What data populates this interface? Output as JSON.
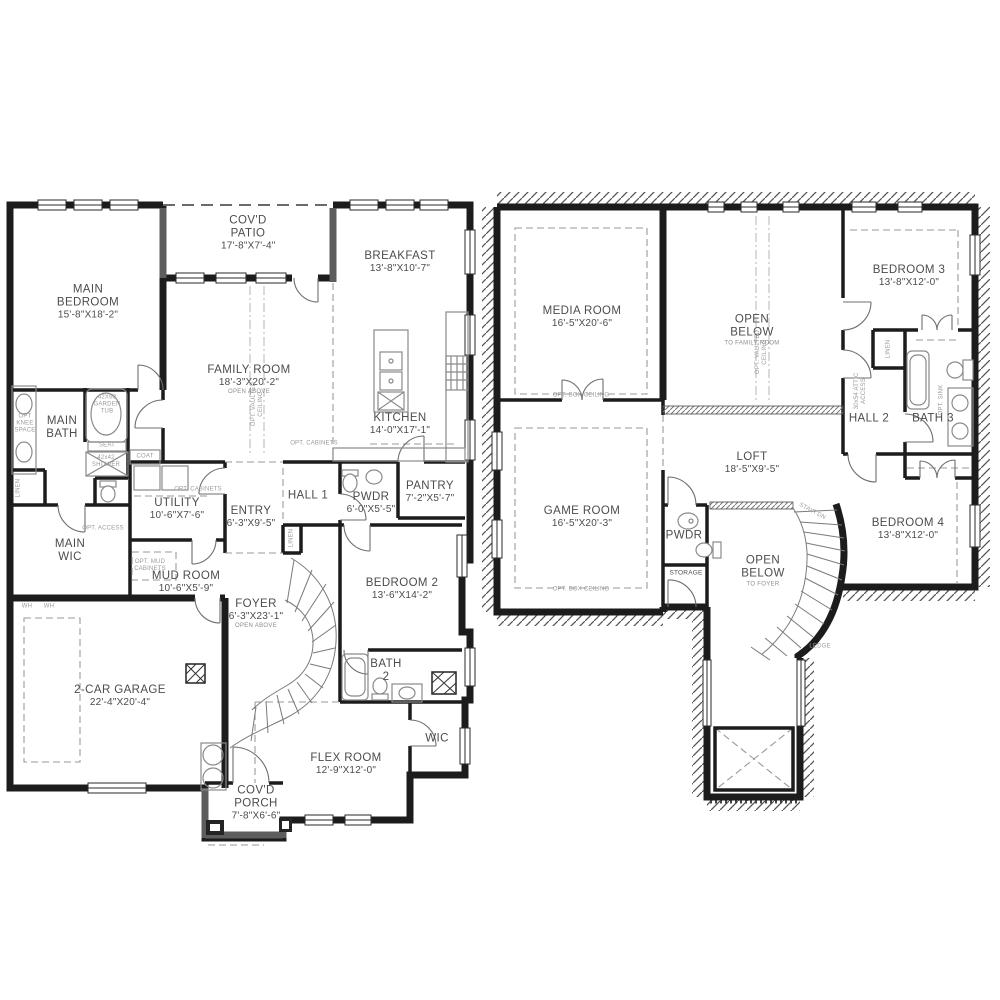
{
  "colors": {
    "bg": "#ffffff",
    "wall": "#1c1c1c",
    "wall_light": "#5d5d5d",
    "label": "#4c4c4c",
    "annot": "#9b9b9b",
    "fixture": "#8a8a8a",
    "dash": "#9a9a9a"
  },
  "floors": [
    {
      "id": "first-floor",
      "rooms": [
        {
          "id": "covd-patio",
          "name": "COV'D PATIO",
          "dims": "17'-8\"X7'-4\"",
          "x": 248,
          "y": 233,
          "w": 54
        },
        {
          "id": "breakfast",
          "name": "BREAKFAST",
          "dims": "13'-8\"X10'-7\"",
          "x": 400,
          "y": 262,
          "w": 120
        },
        {
          "id": "main-bedroom",
          "name": "MAIN BEDROOM",
          "dims": "15'-8\"X18'-2\"",
          "x": 88,
          "y": 302,
          "w": 78
        },
        {
          "id": "family-room",
          "name": "FAMILY ROOM",
          "dims": "18'-3\"X20'-2\"",
          "note": "OPEN ABOVE",
          "x": 249,
          "y": 380,
          "w": 130
        },
        {
          "id": "kitchen",
          "name": "KITCHEN",
          "dims": "14'-0\"X17'-1\"",
          "x": 400,
          "y": 424,
          "w": 110
        },
        {
          "id": "main-bath",
          "name": "MAIN BATH",
          "x": 62,
          "y": 428,
          "w": 42
        },
        {
          "id": "hall-1",
          "name": "HALL 1",
          "x": 308,
          "y": 496,
          "w": 60
        },
        {
          "id": "pwdr-1",
          "name": "PWDR",
          "dims": "6'-0\"X5'-5\"",
          "x": 371,
          "y": 503,
          "w": 76
        },
        {
          "id": "pantry",
          "name": "PANTRY",
          "dims": "7'-2\"X5'-7\"",
          "x": 430,
          "y": 492,
          "w": 70
        },
        {
          "id": "utility",
          "name": "UTILITY",
          "dims": "10'-6\"X7'-6\"",
          "x": 177,
          "y": 509,
          "w": 100
        },
        {
          "id": "entry",
          "name": "ENTRY",
          "dims": "6'-3\"X9'-5\"",
          "x": 251,
          "y": 517,
          "w": 60
        },
        {
          "id": "main-wic",
          "name": "MAIN WIC",
          "x": 70,
          "y": 551,
          "w": 42
        },
        {
          "id": "mud-room",
          "name": "MUD ROOM",
          "dims": "10'-6\"X5'-9\"",
          "x": 186,
          "y": 582,
          "w": 110
        },
        {
          "id": "foyer",
          "name": "FOYER",
          "dims": "6'-3\"X23'-1\"",
          "note": "OPEN ABOVE",
          "x": 256,
          "y": 614,
          "w": 90
        },
        {
          "id": "bedroom-2",
          "name": "BEDROOM 2",
          "dims": "13'-6\"X14'-2\"",
          "x": 402,
          "y": 589,
          "w": 120
        },
        {
          "id": "garage",
          "name": "2-CAR GARAGE",
          "dims": "22'-4\"X20'-4\"",
          "x": 120,
          "y": 696,
          "w": 150
        },
        {
          "id": "bath-2",
          "name": "BATH 2",
          "x": 386,
          "y": 671,
          "w": 36
        },
        {
          "id": "wic",
          "name": "WIC",
          "x": 437,
          "y": 739,
          "w": 40
        },
        {
          "id": "flex-room",
          "name": "FLEX ROOM",
          "dims": "12'-9\"X12'-0\"",
          "x": 346,
          "y": 764,
          "w": 120
        },
        {
          "id": "covd-porch",
          "name": "COV'D PORCH",
          "dims": "7'-8\"X6'-6\"",
          "x": 256,
          "y": 803,
          "w": 56
        }
      ],
      "annotations": [
        {
          "t": "42X60 GARDEN TUB",
          "x": 107,
          "y": 405,
          "w": 36
        },
        {
          "t": "SEAT",
          "x": 107,
          "y": 446
        },
        {
          "t": "42x42 SHOWER",
          "x": 106,
          "y": 462,
          "w": 32
        },
        {
          "t": "COAT",
          "x": 145,
          "y": 457
        },
        {
          "t": "LINEN",
          "x": 19,
          "y": 488,
          "r": -90
        },
        {
          "t": "OPT KNEE SPACE",
          "x": 25,
          "y": 424,
          "w": 26
        },
        {
          "t": "OPT. CABINETS",
          "x": 198,
          "y": 490,
          "w": 70
        },
        {
          "t": "OPT. ACCESS",
          "x": 103,
          "y": 529,
          "w": 50
        },
        {
          "t": "OPT. MUD CABINETS",
          "x": 150,
          "y": 566,
          "w": 52
        },
        {
          "t": "WH",
          "x": 27,
          "y": 607
        },
        {
          "t": "WH",
          "x": 49,
          "y": 607
        },
        {
          "t": "OPT. VAULTED CEILING",
          "x": 258,
          "y": 404,
          "r": -90,
          "w": 64
        },
        {
          "t": "OPT. CABINETS",
          "x": 314,
          "y": 444,
          "w": 70
        },
        {
          "t": "LINEN",
          "x": 292,
          "y": 538,
          "r": -90
        }
      ]
    },
    {
      "id": "second-floor",
      "rooms": [
        {
          "id": "media-room",
          "name": "MEDIA ROOM",
          "dims": "16'-5\"X20'-6\"",
          "x": 582,
          "y": 317,
          "w": 130
        },
        {
          "id": "open-below-family",
          "name": "OPEN BELOW",
          "note": "TO FAMILY ROOM",
          "x": 752,
          "y": 330,
          "w": 60
        },
        {
          "id": "bedroom-3",
          "name": "BEDROOM 3",
          "dims": "13'-8\"X12'-0\"",
          "x": 909,
          "y": 276,
          "w": 120
        },
        {
          "id": "hall-2",
          "name": "HALL 2",
          "x": 869,
          "y": 419,
          "w": 60
        },
        {
          "id": "bath-3",
          "name": "BATH 3",
          "x": 933,
          "y": 419,
          "w": 60
        },
        {
          "id": "loft",
          "name": "LOFT",
          "dims": "18'-5\"X9'-5\"",
          "x": 752,
          "y": 463,
          "w": 100
        },
        {
          "id": "game-room",
          "name": "GAME ROOM",
          "dims": "16'-5\"X20'-3\"",
          "x": 582,
          "y": 517,
          "w": 130
        },
        {
          "id": "pwdr-2",
          "name": "PWDR",
          "x": 684,
          "y": 536,
          "w": 50
        },
        {
          "id": "open-below-foyer",
          "name": "OPEN BELOW",
          "note": "TO FOYER",
          "x": 763,
          "y": 571,
          "w": 60
        },
        {
          "id": "bedroom-4",
          "name": "BEDROOM 4",
          "dims": "13'-8\"X12'-0\"",
          "x": 908,
          "y": 529,
          "w": 120
        }
      ],
      "annotations": [
        {
          "t": "OPT. BOX CEILING",
          "x": 581,
          "y": 396,
          "w": 90
        },
        {
          "t": "OPT. BOX CEILING",
          "x": 581,
          "y": 590,
          "w": 90
        },
        {
          "t": "OPT. VAULTED CEILING",
          "x": 762,
          "y": 352,
          "r": -90,
          "w": 64
        },
        {
          "t": "LINEN",
          "x": 889,
          "y": 349,
          "r": -90
        },
        {
          "t": "30x54 ATTIC ACCESS",
          "x": 861,
          "y": 391,
          "r": -90,
          "w": 40
        },
        {
          "t": "OPT. SINK",
          "x": 942,
          "y": 400,
          "r": -90
        },
        {
          "t": "STAIR DN",
          "x": 812,
          "y": 512,
          "r": 28
        },
        {
          "t": "LEDGE",
          "x": 820,
          "y": 647
        },
        {
          "t": "STORAGE",
          "x": 686,
          "y": 573,
          "c": "dk"
        }
      ]
    }
  ]
}
